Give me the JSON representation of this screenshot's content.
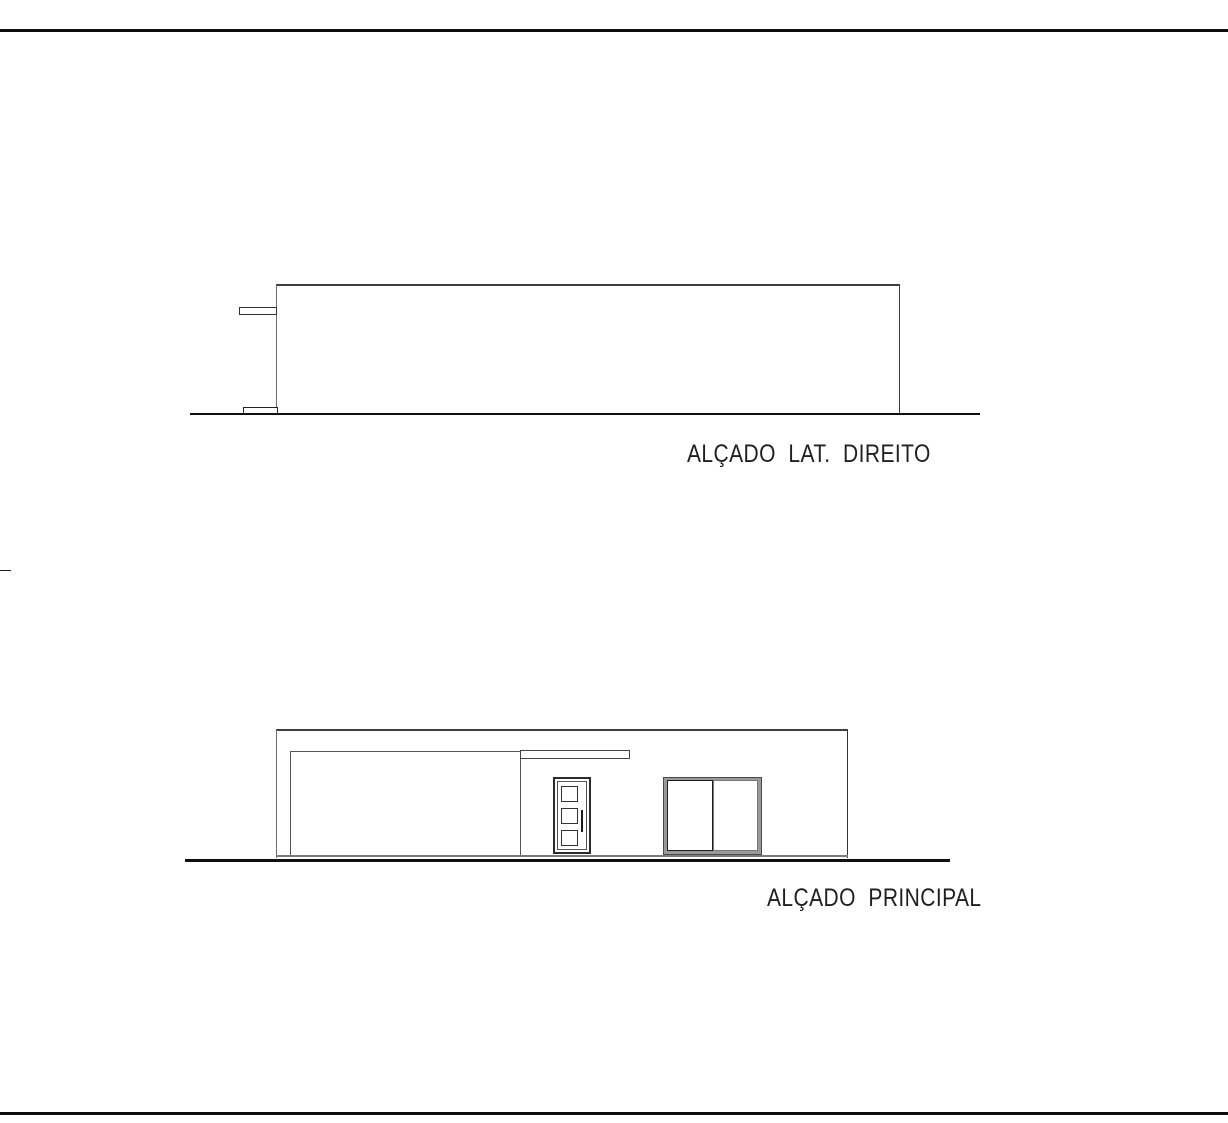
{
  "drawing": {
    "sheet": {
      "background": "#ffffff",
      "border_line_color": "#0d0d0d"
    },
    "line_colors": {
      "heavy_ground": "#0f0f0f",
      "roof_edge": "#3f3f3f",
      "wall_edge": "#6f6f6f",
      "window_frame_gray": "#999999",
      "door_frame_dark": "#2b2b2b"
    },
    "elevations": [
      {
        "id": "side-right",
        "label": "ALÇADO  LAT.  DIREITO"
      },
      {
        "id": "front",
        "label": "ALÇADO  PRINCIPAL"
      }
    ]
  }
}
